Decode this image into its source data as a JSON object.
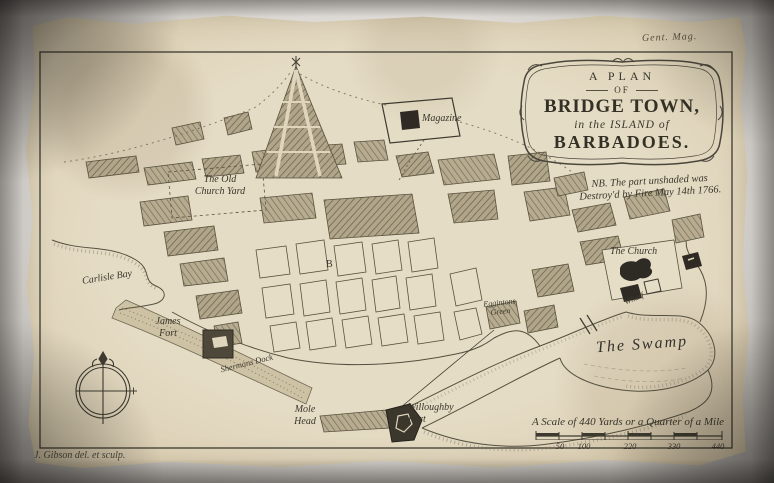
{
  "page": {
    "publication_mark": "Gent. Mag.",
    "signature": "J. Gibson del. et sculp."
  },
  "cartouche": {
    "line1": "A PLAN",
    "line2": "OF",
    "line3": "BRIDGE TOWN,",
    "line4": "in the ISLAND of",
    "line5": "BARBADOES."
  },
  "note": {
    "line1": "NB. The part unshaded was",
    "line2": "Destroy'd by Fire May 14th 1766."
  },
  "places": {
    "magazine": "Magazine",
    "old_church_yard_line1": "The Old",
    "old_church_yard_line2": "Church Yard",
    "carlisle_bay": "Carlisle Bay",
    "james_fort_line1": "James",
    "james_fort_line2": "Fort",
    "dock": "Shermans Dock",
    "reference_letter": "B",
    "the_church": "The Church",
    "wharf": "Wharf",
    "green_line1": "Eggintons",
    "green_line2": "Green",
    "the_swamp": "The Swamp",
    "mole_head_line1": "Mole",
    "mole_head_line2": "Head",
    "willoughby_fort_line1": "Willoughby",
    "willoughby_fort_line2": "Fort"
  },
  "scale_bar": {
    "title": "A Scale of 440 Yards or a Quarter of a Mile",
    "ticks": [
      "50",
      "100",
      "220",
      "330",
      "440"
    ]
  },
  "colors": {
    "paper": "#dcd0b4",
    "ink": "#3e3a30",
    "hatch_fill": "#b3a88d",
    "hatch_line": "#6e6753",
    "mat_background": "#c7c4bf"
  }
}
